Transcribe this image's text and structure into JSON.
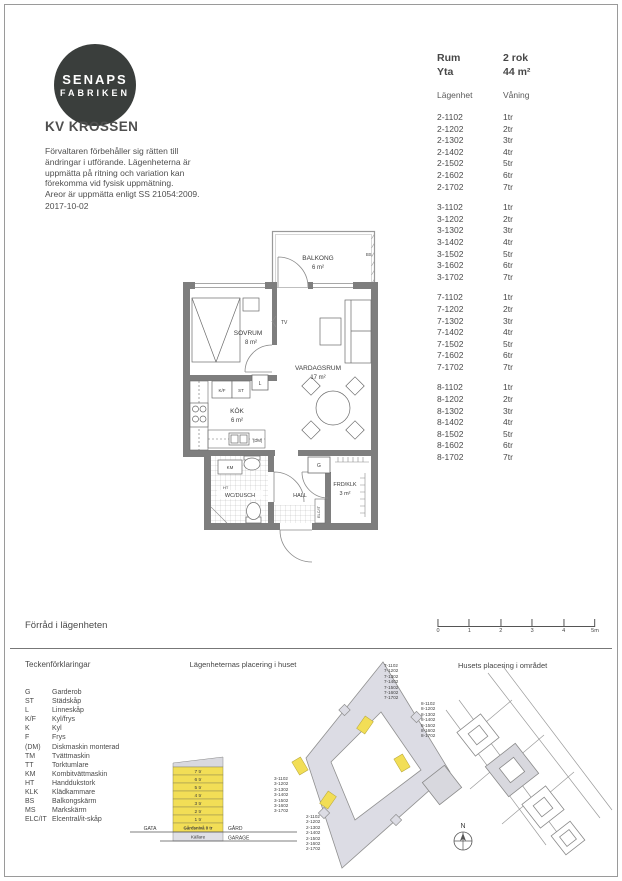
{
  "header": {
    "logo_line1": "SENAPS",
    "logo_line2": "FABRIKEN",
    "title": "KV KROSSEN",
    "disclaimer_lines": [
      "Förvaltaren förbehåller sig rätten till",
      "ändringar i utförande. Lägenheterna är",
      "uppmätta på ritning och variation kan",
      "förekomma vid fysisk uppmätning.",
      "Areor är uppmätta enligt SS 21054:2009."
    ],
    "date": "2017-10-02"
  },
  "info": {
    "rum_label": "Rum",
    "rum_value": "2 rok",
    "yta_label": "Yta",
    "yta_value": "44 m²",
    "col_apartment": "Lägenhet",
    "col_floor": "Våning",
    "groups": {
      "g2": [
        {
          "apt": "2-1102",
          "floor": "1tr"
        },
        {
          "apt": "2-1202",
          "floor": "2tr"
        },
        {
          "apt": "2-1302",
          "floor": "3tr"
        },
        {
          "apt": "2-1402",
          "floor": "4tr"
        },
        {
          "apt": "2-1502",
          "floor": "5tr"
        },
        {
          "apt": "2-1602",
          "floor": "6tr"
        },
        {
          "apt": "2-1702",
          "floor": "7tr"
        }
      ],
      "g3": [
        {
          "apt": "3-1102",
          "floor": "1tr"
        },
        {
          "apt": "3-1202",
          "floor": "2tr"
        },
        {
          "apt": "3-1302",
          "floor": "3tr"
        },
        {
          "apt": "3-1402",
          "floor": "4tr"
        },
        {
          "apt": "3-1502",
          "floor": "5tr"
        },
        {
          "apt": "3-1602",
          "floor": "6tr"
        },
        {
          "apt": "3-1702",
          "floor": "7tr"
        }
      ],
      "g7": [
        {
          "apt": "7-1102",
          "floor": "1tr"
        },
        {
          "apt": "7-1202",
          "floor": "2tr"
        },
        {
          "apt": "7-1302",
          "floor": "3tr"
        },
        {
          "apt": "7-1402",
          "floor": "4tr"
        },
        {
          "apt": "7-1502",
          "floor": "5tr"
        },
        {
          "apt": "7-1602",
          "floor": "6tr"
        },
        {
          "apt": "7-1702",
          "floor": "7tr"
        }
      ],
      "g8": [
        {
          "apt": "8-1102",
          "floor": "1tr"
        },
        {
          "apt": "8-1202",
          "floor": "2tr"
        },
        {
          "apt": "8-1302",
          "floor": "3tr"
        },
        {
          "apt": "8-1402",
          "floor": "4tr"
        },
        {
          "apt": "8-1502",
          "floor": "5tr"
        },
        {
          "apt": "8-1602",
          "floor": "6tr"
        },
        {
          "apt": "8-1702",
          "floor": "7tr"
        }
      ]
    }
  },
  "floorplan": {
    "rooms": {
      "balkong": {
        "name": "BALKONG",
        "area": "6 m²"
      },
      "sovrum": {
        "name": "SOVRUM",
        "area": "8 m²"
      },
      "vardagsrum": {
        "name": "VARDAGSRUM",
        "area": "17 m²"
      },
      "kok": {
        "name": "KÖK",
        "area": "6 m²"
      },
      "wc": {
        "name": "WC/DUSCH"
      },
      "hall": {
        "name": "HALL"
      },
      "frd": {
        "name": "FRD/KLK",
        "area": "3 m²"
      }
    },
    "labels": {
      "tv": "TV",
      "bs": "BS",
      "l": "L",
      "kf": "K/F",
      "st": "ST",
      "dm": "(DM)",
      "km": "KM",
      "ht": "HT",
      "g": "G",
      "elcit": "ELC/IT"
    }
  },
  "storage_note": "Förråd i lägenheten",
  "scalebar": {
    "ticks": [
      "0",
      "1",
      "2",
      "3",
      "4",
      "5m"
    ]
  },
  "legend": {
    "title": "Teckenförklaringar",
    "items": [
      {
        "abbr": "G",
        "desc": "Garderob"
      },
      {
        "abbr": "ST",
        "desc": "Städskåp"
      },
      {
        "abbr": "L",
        "desc": "Linneskåp"
      },
      {
        "abbr": "K/F",
        "desc": "Kyl/frys"
      },
      {
        "abbr": "K",
        "desc": "Kyl"
      },
      {
        "abbr": "F",
        "desc": "Frys"
      },
      {
        "abbr": "(DM)",
        "desc": "Diskmaskin monterad"
      },
      {
        "abbr": "TM",
        "desc": "Tvättmaskin"
      },
      {
        "abbr": "TT",
        "desc": "Torktumlare"
      },
      {
        "abbr": "KM",
        "desc": "Kombitvättmaskin"
      },
      {
        "abbr": "HT",
        "desc": "Handdukstork"
      },
      {
        "abbr": "KLK",
        "desc": "Klädkammare"
      },
      {
        "abbr": "BS",
        "desc": "Balkongskärm"
      },
      {
        "abbr": "MS",
        "desc": "Markskärm"
      },
      {
        "abbr": "ELC/IT",
        "desc": "Elcentral/it-skåp"
      }
    ]
  },
  "section": {
    "title": "Lägenheternas placering i huset",
    "floors": [
      "7 tr",
      "6 tr",
      "5 tr",
      "4 tr",
      "3 tr",
      "2 tr",
      "1 tr"
    ],
    "ground": "Gårdsnivå 0 tr",
    "basement": "Källare",
    "gata": "GATA",
    "gard": "GÅRD",
    "garage": "GARAGE",
    "lists": {
      "g7": [
        "7-1102",
        "7-1202",
        "7-1302",
        "7-1402",
        "7-1502",
        "7-1602",
        "7-1702"
      ],
      "g8": [
        "8-1102",
        "8-1202",
        "8-1302",
        "8-1402",
        "8-1502",
        "8-1602",
        "8-1702"
      ],
      "g3": [
        "3-1102",
        "3-1202",
        "3-1302",
        "3-1402",
        "3-1502",
        "3-1602",
        "3-1702"
      ],
      "g2": [
        "2-1102",
        "2-1202",
        "2-1302",
        "2-1402",
        "2-1502",
        "2-1602",
        "2-1702"
      ]
    }
  },
  "site": {
    "title": "Husets placering i området",
    "north": "N"
  },
  "colors": {
    "highlight": "#f2de56",
    "building_fill": "#dcdce4",
    "logo_bg": "#3a3e3c",
    "wall": "#7e7e7e"
  }
}
